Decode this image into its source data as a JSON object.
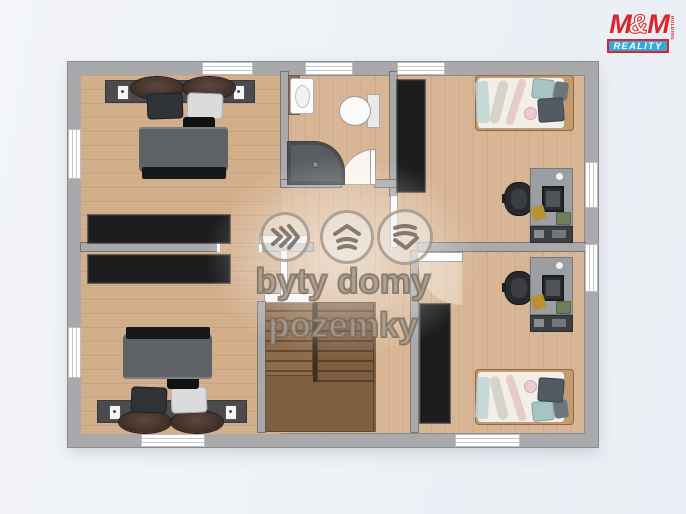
{
  "watermark": {
    "line": "byty domy pozemky",
    "icons": [
      "waves-right-icon",
      "house-roof-icon",
      "terrain-layers-icon"
    ]
  },
  "logo": {
    "m1": "M",
    "amp": "&",
    "m2": "M",
    "holding": "HOLDING",
    "band": "REALITY"
  },
  "palette": {
    "wall": "#a9a9ab",
    "wardrobe": "#1d1d1f",
    "floor_wood": "#d3ae8b",
    "floor_wood_right": "#d8b594",
    "bath_tile": "#efefec",
    "stair_wood": "#8e6b4b",
    "stair_landing": "#7e5f42",
    "duvet_gray": "#5f6368",
    "bed_frame_tan": "#c49b6f",
    "teal_pillow": "#a6c4c5",
    "desk_gray": "#9b9ea2",
    "logo_red": "#d8262c",
    "logo_blue": "#35a8da",
    "background": "#eff1f6"
  }
}
